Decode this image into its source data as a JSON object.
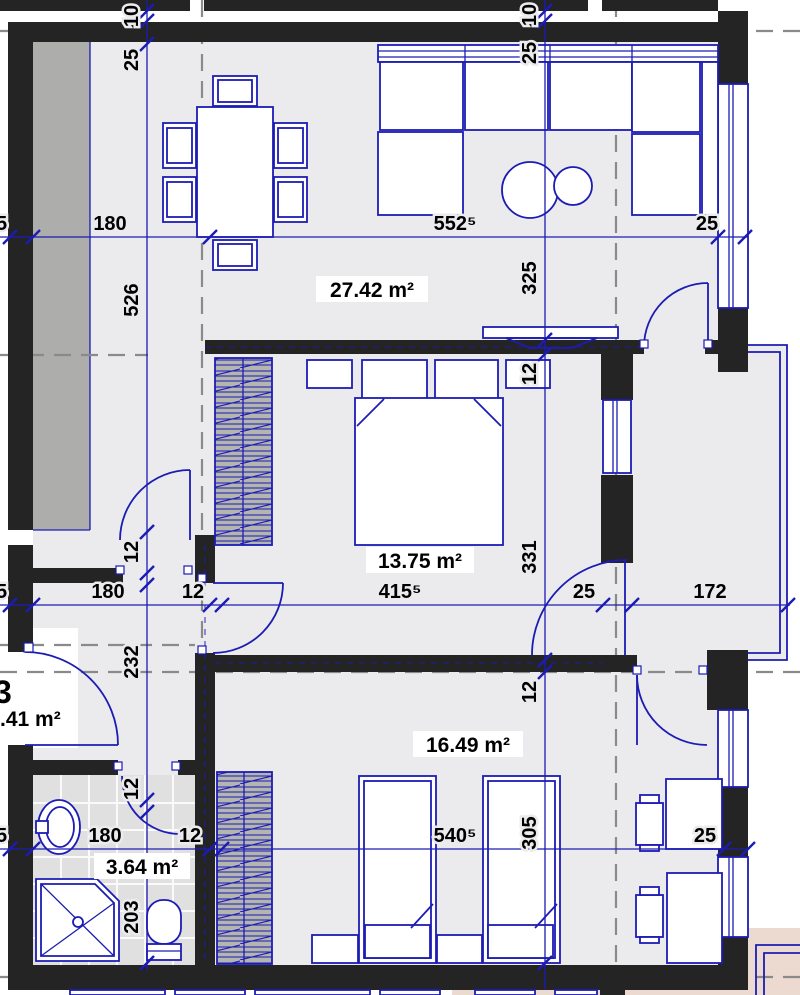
{
  "rooms": {
    "living": "27.42 m²",
    "bedroom": "13.75 m²",
    "kids": "16.49 m²",
    "bath": "3.64 m²",
    "hall_cut": ".41 m²",
    "unit_cut": "3"
  },
  "dims": {
    "h1": {
      "left_cut": "5",
      "a": "180",
      "b": "552⁵",
      "c": "25"
    },
    "h2": {
      "left_cut": "5",
      "a": "180",
      "b": "12",
      "c": "415⁵",
      "d": "25",
      "e": "172"
    },
    "h3": {
      "left_cut": "5",
      "a": "180",
      "b": "12",
      "c": "540⁵",
      "d": "25"
    },
    "va": {
      "a": "10",
      "b": "25",
      "c": "526",
      "d": "12",
      "e": "232",
      "f": "12",
      "g": "203"
    },
    "vb": {
      "a": "10",
      "b": "25",
      "c": "325",
      "d": "12",
      "e": "331",
      "f": "12",
      "g": "305"
    }
  },
  "colors": {
    "line_blue": "#1c1cb4",
    "wall_black": "#242424",
    "floor_gray": "#ebebed",
    "shaft_gray": "#adadab",
    "tile_gray": "#e2e2e2",
    "neighbor_pink": "#ecdad1",
    "axis_gray": "#8a8a8a"
  }
}
